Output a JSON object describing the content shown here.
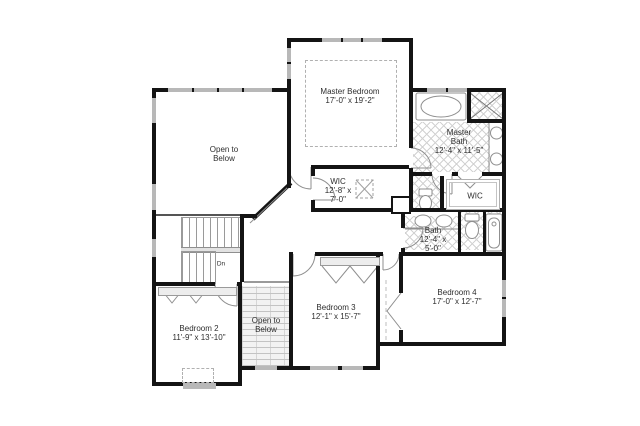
{
  "colors": {
    "wall": "#141414",
    "window": "#b8b8b8",
    "mullion": "#141414",
    "line": "#8f8f8f",
    "label": "#2e2e2e",
    "tileline": "#d2d2d2",
    "brickbg": "#f2f2f2",
    "brickline": "#c3c3c3",
    "dash": "#b0b0b0",
    "stair": "#9a9a9a"
  },
  "rooms": {
    "master_bedroom": {
      "lines": [
        "Master Bedroom",
        "17'-0\" x 19'-2\""
      ]
    },
    "master_bath": {
      "lines": [
        "Master",
        "Bath",
        "12'-4\" x 11'-5\""
      ]
    },
    "wic_left": {
      "lines": [
        "WIC",
        "12'-8\" x",
        "7'-0\""
      ]
    },
    "wic_right": {
      "lines": [
        "WIC"
      ]
    },
    "hall_bath": {
      "lines": [
        "Bath",
        "12'-4\" x",
        "5'-0\""
      ]
    },
    "bedroom_2": {
      "lines": [
        "Bedroom 2",
        "11'-9\" x 13'-10\""
      ]
    },
    "bedroom_3": {
      "lines": [
        "Bedroom 3",
        "12'-1\" x 15'-7\""
      ]
    },
    "bedroom_4": {
      "lines": [
        "Bedroom 4",
        "17'-0\" x 12'-7\""
      ]
    },
    "open_below_upper": {
      "lines": [
        "Open to",
        "Below"
      ]
    },
    "open_below_lower": {
      "lines": [
        "Open to",
        "Below"
      ]
    }
  },
  "stairs": {
    "down_label": "Dn"
  }
}
